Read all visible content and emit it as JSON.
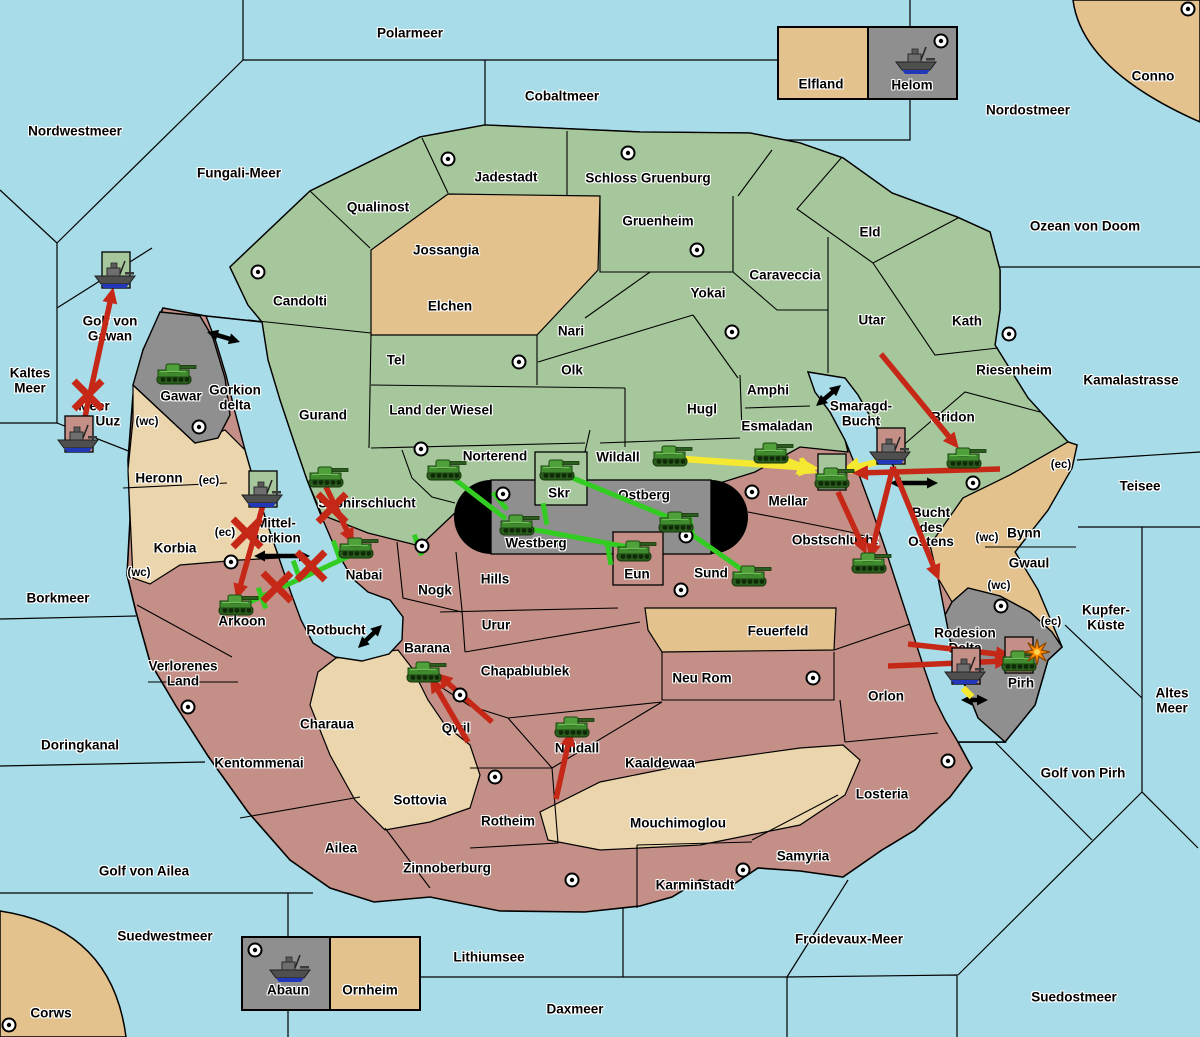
{
  "palette": {
    "sea": "#A8DCE8",
    "green_land": "#A6C79B",
    "tan_light": "#E3C28E",
    "tan_pale": "#EBD5AC",
    "red_land": "#C38F86",
    "gray_land": "#8F8F8F",
    "border": "#000000",
    "arrow_red": "#C62818",
    "arrow_green": "#33CC22",
    "arrow_yellow": "#F5E830",
    "arrow_black": "#000000",
    "explosion": "#FF8C00"
  },
  "labels": [
    {
      "k": "sea",
      "t": "Polarmeer",
      "x": 410,
      "y": 34
    },
    {
      "k": "sea",
      "t": "Nordwestmeer",
      "x": 75,
      "y": 132
    },
    {
      "k": "sea",
      "t": "Fungali-Meer",
      "x": 239,
      "y": 174
    },
    {
      "k": "sea",
      "t": "Cobaltmeer",
      "x": 562,
      "y": 97
    },
    {
      "k": "sea",
      "t": "Nordostmeer",
      "x": 1028,
      "y": 111
    },
    {
      "k": "sea",
      "t": "Conno",
      "x": 1153,
      "y": 77
    },
    {
      "k": "sea",
      "t": "Ozean von Doom",
      "x": 1085,
      "y": 227
    },
    {
      "k": "sea",
      "t": "Kaltes\nMeer",
      "x": 30,
      "y": 381
    },
    {
      "k": "sea",
      "t": "Golf von\nGawan",
      "x": 110,
      "y": 329
    },
    {
      "k": "sea",
      "t": "Meer\nvon Uuz",
      "x": 94,
      "y": 414
    },
    {
      "k": "sea",
      "t": "Gorkion\ndelta",
      "x": 235,
      "y": 398
    },
    {
      "k": "sea",
      "t": "Kamalastrasse",
      "x": 1131,
      "y": 381
    },
    {
      "k": "sea",
      "t": "Teisee",
      "x": 1140,
      "y": 487
    },
    {
      "k": "sea",
      "t": "Borkmeer",
      "x": 58,
      "y": 599
    },
    {
      "k": "sea",
      "t": "Kupfer-\nKüste",
      "x": 1106,
      "y": 618
    },
    {
      "k": "sea",
      "t": "Altes\nMeer",
      "x": 1172,
      "y": 701
    },
    {
      "k": "sea",
      "t": "Golf von Pirh",
      "x": 1083,
      "y": 774
    },
    {
      "k": "sea",
      "t": "Doringkanal",
      "x": 80,
      "y": 746
    },
    {
      "k": "sea",
      "t": "Golf von Ailea",
      "x": 144,
      "y": 872
    },
    {
      "k": "sea",
      "t": "Suedwestmeer",
      "x": 165,
      "y": 937
    },
    {
      "k": "sea",
      "t": "Corws",
      "x": 51,
      "y": 1014
    },
    {
      "k": "sea",
      "t": "Lithiumsee",
      "x": 489,
      "y": 958
    },
    {
      "k": "sea",
      "t": "Daxmeer",
      "x": 575,
      "y": 1010
    },
    {
      "k": "sea",
      "t": "Froidevaux-Meer",
      "x": 849,
      "y": 940
    },
    {
      "k": "sea",
      "t": "Suedostmeer",
      "x": 1074,
      "y": 998
    },
    {
      "k": "sea",
      "t": "Smaragd-\nBucht",
      "x": 861,
      "y": 414
    },
    {
      "k": "sea",
      "t": "Bucht\ndes\nOstens",
      "x": 931,
      "y": 528
    },
    {
      "k": "sea",
      "t": "Rotbucht",
      "x": 336,
      "y": 631
    },
    {
      "k": "sea",
      "t": "Mittel-\ngorkion",
      "x": 276,
      "y": 531
    },
    {
      "k": "land",
      "t": "Jadestadt",
      "x": 506,
      "y": 178
    },
    {
      "k": "land",
      "t": "Schloss Gruenburg",
      "x": 648,
      "y": 179
    },
    {
      "k": "land",
      "t": "Qualinost",
      "x": 378,
      "y": 208
    },
    {
      "k": "land",
      "t": "Jossangia",
      "x": 446,
      "y": 251
    },
    {
      "k": "land",
      "t": "Gruenheim",
      "x": 658,
      "y": 222
    },
    {
      "k": "land",
      "t": "Caraveccia",
      "x": 785,
      "y": 276
    },
    {
      "k": "land",
      "t": "Yokai",
      "x": 708,
      "y": 294
    },
    {
      "k": "land",
      "t": "Candolti",
      "x": 300,
      "y": 302
    },
    {
      "k": "land",
      "t": "Elchen",
      "x": 450,
      "y": 307
    },
    {
      "k": "land",
      "t": "Nari",
      "x": 571,
      "y": 332
    },
    {
      "k": "land",
      "t": "Olk",
      "x": 572,
      "y": 371
    },
    {
      "k": "land",
      "t": "Tel",
      "x": 396,
      "y": 361
    },
    {
      "k": "land",
      "t": "Eld",
      "x": 870,
      "y": 233
    },
    {
      "k": "land",
      "t": "Utar",
      "x": 872,
      "y": 321
    },
    {
      "k": "land",
      "t": "Kath",
      "x": 967,
      "y": 322
    },
    {
      "k": "land",
      "t": "Riesenheim",
      "x": 1014,
      "y": 371
    },
    {
      "k": "land",
      "t": "Land der Wiesel",
      "x": 441,
      "y": 411
    },
    {
      "k": "land",
      "t": "Gurand",
      "x": 323,
      "y": 416
    },
    {
      "k": "land",
      "t": "Hugl",
      "x": 702,
      "y": 410
    },
    {
      "k": "land",
      "t": "Amphi",
      "x": 768,
      "y": 391
    },
    {
      "k": "land",
      "t": "Esmaladan",
      "x": 777,
      "y": 427
    },
    {
      "k": "land",
      "t": "Bridon",
      "x": 953,
      "y": 418
    },
    {
      "k": "land",
      "t": "Norterend",
      "x": 495,
      "y": 457
    },
    {
      "k": "land",
      "t": "Wildall",
      "x": 618,
      "y": 458
    },
    {
      "k": "land",
      "t": "Saphirschlucht",
      "x": 367,
      "y": 504
    },
    {
      "k": "land",
      "t": "Gawar",
      "x": 181,
      "y": 397
    },
    {
      "k": "land",
      "t": "Skr",
      "x": 559,
      "y": 494
    },
    {
      "k": "land",
      "t": "Ostberg",
      "x": 644,
      "y": 496
    },
    {
      "k": "land",
      "t": "Westberg",
      "x": 536,
      "y": 544
    },
    {
      "k": "land",
      "t": "Eun",
      "x": 637,
      "y": 575
    },
    {
      "k": "land",
      "t": "Sund",
      "x": 711,
      "y": 574
    },
    {
      "k": "land",
      "t": "Mellar",
      "x": 788,
      "y": 502
    },
    {
      "k": "land",
      "t": "Obstschlucht",
      "x": 835,
      "y": 541
    },
    {
      "k": "land",
      "t": "Hills",
      "x": 495,
      "y": 580
    },
    {
      "k": "land",
      "t": "Nogk",
      "x": 435,
      "y": 591
    },
    {
      "k": "land",
      "t": "Nabai",
      "x": 364,
      "y": 576
    },
    {
      "k": "land",
      "t": "Urur",
      "x": 496,
      "y": 626
    },
    {
      "k": "land",
      "t": "Arkoon",
      "x": 242,
      "y": 622
    },
    {
      "k": "land",
      "t": "Verlorenes\nLand",
      "x": 183,
      "y": 674
    },
    {
      "k": "land",
      "t": "Barana",
      "x": 427,
      "y": 649
    },
    {
      "k": "land",
      "t": "Feuerfeld",
      "x": 778,
      "y": 632
    },
    {
      "k": "land",
      "t": "Neu Rom",
      "x": 702,
      "y": 679
    },
    {
      "k": "land",
      "t": "Chapablublek",
      "x": 525,
      "y": 672
    },
    {
      "k": "land",
      "t": "Qwil",
      "x": 456,
      "y": 729
    },
    {
      "k": "land",
      "t": "Charaua",
      "x": 327,
      "y": 725
    },
    {
      "k": "land",
      "t": "Kentommenai",
      "x": 259,
      "y": 764
    },
    {
      "k": "land",
      "t": "Orlon",
      "x": 886,
      "y": 697
    },
    {
      "k": "land",
      "t": "Nilldall",
      "x": 577,
      "y": 749
    },
    {
      "k": "land",
      "t": "Kaaldewaa",
      "x": 660,
      "y": 764
    },
    {
      "k": "land",
      "t": "Sottovia",
      "x": 420,
      "y": 801
    },
    {
      "k": "land",
      "t": "Rotheim",
      "x": 508,
      "y": 822
    },
    {
      "k": "land",
      "t": "Mouchimoglou",
      "x": 678,
      "y": 824
    },
    {
      "k": "land",
      "t": "Losteria",
      "x": 882,
      "y": 795
    },
    {
      "k": "land",
      "t": "Ailea",
      "x": 341,
      "y": 849
    },
    {
      "k": "land",
      "t": "Zinnoberburg",
      "x": 447,
      "y": 869
    },
    {
      "k": "land",
      "t": "Karminstadt",
      "x": 695,
      "y": 886
    },
    {
      "k": "land",
      "t": "Samyria",
      "x": 803,
      "y": 857
    },
    {
      "k": "land",
      "t": "Pirh",
      "x": 1021,
      "y": 684
    },
    {
      "k": "land",
      "t": "Gwaul",
      "x": 1029,
      "y": 564
    },
    {
      "k": "land",
      "t": "Bynn",
      "x": 1024,
      "y": 534
    },
    {
      "k": "land",
      "t": "Heronn",
      "x": 159,
      "y": 479
    },
    {
      "k": "land",
      "t": "Korbia",
      "x": 175,
      "y": 549
    },
    {
      "k": "land",
      "t": "Rodesion\nDelta",
      "x": 965,
      "y": 641
    },
    {
      "k": "land",
      "t": "Elfland",
      "x": 821,
      "y": 85
    },
    {
      "k": "land",
      "t": "Helom",
      "x": 912,
      "y": 86
    },
    {
      "k": "land",
      "t": "Abaun",
      "x": 288,
      "y": 991
    },
    {
      "k": "land",
      "t": "Ornheim",
      "x": 370,
      "y": 991
    },
    {
      "k": "coast",
      "t": "(wc)",
      "x": 147,
      "y": 422
    },
    {
      "k": "coast",
      "t": "(ec)",
      "x": 209,
      "y": 481
    },
    {
      "k": "coast",
      "t": "(ec)",
      "x": 225,
      "y": 533
    },
    {
      "k": "coast",
      "t": "(wc)",
      "x": 139,
      "y": 573
    },
    {
      "k": "coast",
      "t": "(wc)",
      "x": 987,
      "y": 538
    },
    {
      "k": "coast",
      "t": "(ec)",
      "x": 1061,
      "y": 465
    },
    {
      "k": "coast",
      "t": "(wc)",
      "x": 999,
      "y": 586
    },
    {
      "k": "coast",
      "t": "(ec)",
      "x": 1051,
      "y": 622
    }
  ],
  "city_markers": [
    [
      448,
      159
    ],
    [
      628,
      153
    ],
    [
      697,
      250
    ],
    [
      258,
      272
    ],
    [
      519,
      362
    ],
    [
      732,
      332
    ],
    [
      941,
      41
    ],
    [
      1188,
      9
    ],
    [
      1009,
      334
    ],
    [
      973,
      483
    ],
    [
      421,
      449
    ],
    [
      503,
      494
    ],
    [
      686,
      536
    ],
    [
      681,
      590
    ],
    [
      752,
      492
    ],
    [
      948,
      761
    ],
    [
      1001,
      606
    ],
    [
      231,
      562
    ],
    [
      422,
      546
    ],
    [
      460,
      695
    ],
    [
      813,
      678
    ],
    [
      495,
      777
    ],
    [
      572,
      880
    ],
    [
      743,
      870
    ],
    [
      188,
      707
    ],
    [
      9,
      1025
    ],
    [
      255,
      950
    ],
    [
      199,
      427
    ]
  ],
  "units": [
    {
      "id": "helom-ship",
      "kind": "ship",
      "x": 917,
      "y": 62,
      "box": null
    },
    {
      "id": "gawan-ship",
      "kind": "ship",
      "x": 116,
      "y": 276,
      "box": "green"
    },
    {
      "id": "uuz-ship",
      "kind": "ship",
      "x": 79,
      "y": 440,
      "box": "pink"
    },
    {
      "id": "mittelgorkion-ship",
      "kind": "ship",
      "x": 263,
      "y": 495,
      "box": "green"
    },
    {
      "id": "ostens-ship",
      "kind": "ship",
      "x": 891,
      "y": 452,
      "box": "pink"
    },
    {
      "id": "rodesion-ship",
      "kind": "ship",
      "x": 966,
      "y": 672,
      "box": "pink"
    },
    {
      "id": "abaun-ship",
      "kind": "ship",
      "x": 291,
      "y": 970,
      "box": null
    },
    {
      "id": "gawar-tank",
      "kind": "tank",
      "x": 174,
      "y": 374,
      "box": null
    },
    {
      "id": "saphirschlucht-tank",
      "kind": "tank",
      "x": 326,
      "y": 477,
      "box": null
    },
    {
      "id": "norterend-tank",
      "kind": "tank",
      "x": 444,
      "y": 470,
      "box": null
    },
    {
      "id": "skr-tank",
      "kind": "tank",
      "x": 557,
      "y": 470,
      "box": null
    },
    {
      "id": "wildall-tank",
      "kind": "tank",
      "x": 670,
      "y": 456,
      "box": null
    },
    {
      "id": "westberg-tank",
      "kind": "tank",
      "x": 517,
      "y": 525,
      "box": null
    },
    {
      "id": "ostberg-tank",
      "kind": "tank",
      "x": 676,
      "y": 522,
      "box": null
    },
    {
      "id": "eun-tank",
      "kind": "tank",
      "x": 634,
      "y": 551,
      "box": null
    },
    {
      "id": "sund-tank",
      "kind": "tank",
      "x": 749,
      "y": 576,
      "box": null
    },
    {
      "id": "esmaladan-tank",
      "kind": "tank",
      "x": 771,
      "y": 453,
      "box": null
    },
    {
      "id": "mellar-tank",
      "kind": "tank",
      "x": 832,
      "y": 478,
      "box": "green"
    },
    {
      "id": "bridon-tank",
      "kind": "tank",
      "x": 964,
      "y": 458,
      "box": null
    },
    {
      "id": "obstschlucht-tank",
      "kind": "tank",
      "x": 869,
      "y": 563,
      "box": null
    },
    {
      "id": "nabai-tank",
      "kind": "tank",
      "x": 356,
      "y": 548,
      "box": null
    },
    {
      "id": "arkoon-tank",
      "kind": "tank",
      "x": 236,
      "y": 605,
      "box": null
    },
    {
      "id": "barana-tank",
      "kind": "tank",
      "x": 424,
      "y": 672,
      "box": null
    },
    {
      "id": "nilldall-tank",
      "kind": "tank",
      "x": 572,
      "y": 727,
      "box": null
    },
    {
      "id": "pirh-tank",
      "kind": "tank",
      "x": 1019,
      "y": 661,
      "box": "pink"
    }
  ],
  "explosion": {
    "x": 1037,
    "y": 652
  },
  "attack_arrows": [
    {
      "c": "green",
      "p": [
        [
          448,
          474
        ],
        [
          506,
          519
        ]
      ],
      "h": 0
    },
    {
      "c": "green",
      "p": [
        [
          520,
          527
        ],
        [
          628,
          547
        ]
      ],
      "h": 0
    },
    {
      "c": "green",
      "p": [
        [
          563,
          474
        ],
        [
          668,
          517
        ]
      ],
      "h": 0
    },
    {
      "c": "green",
      "p": [
        [
          681,
          527
        ],
        [
          744,
          571
        ]
      ],
      "h": 0
    },
    {
      "c": "green",
      "p": [
        [
          356,
          553
        ],
        [
          250,
          602
        ]
      ],
      "h": 0
    },
    {
      "c": "yellow",
      "p": [
        [
          684,
          459
        ],
        [
          813,
          468
        ]
      ],
      "h": 1
    },
    {
      "c": "yellow",
      "p": [
        [
          778,
          457
        ],
        [
          812,
          471
        ]
      ],
      "h": 1
    },
    {
      "c": "yellow",
      "p": [
        [
          877,
          462
        ],
        [
          846,
          470
        ]
      ],
      "h": 1
    },
    {
      "c": "yellow",
      "p": [
        [
          967,
          662
        ],
        [
          951,
          679
        ]
      ],
      "h": 0
    },
    {
      "c": "yellow",
      "p": [
        [
          963,
          688
        ],
        [
          972,
          697
        ]
      ],
      "h": 0
    },
    {
      "c": "red",
      "p": [
        [
          80,
          440
        ],
        [
          112,
          293
        ]
      ],
      "h": 1
    },
    {
      "c": "red",
      "p": [
        [
          263,
          505
        ],
        [
          238,
          594
        ]
      ],
      "h": 1
    },
    {
      "c": "red",
      "p": [
        [
          326,
          487
        ],
        [
          351,
          539
        ]
      ],
      "h": 1
    },
    {
      "c": "red",
      "p": [
        [
          1000,
          469
        ],
        [
          858,
          473
        ]
      ],
      "h": 1
    },
    {
      "c": "red",
      "p": [
        [
          893,
          467
        ],
        [
          871,
          554
        ]
      ],
      "h": 1
    },
    {
      "c": "red",
      "p": [
        [
          893,
          467
        ],
        [
          937,
          575
        ]
      ],
      "h": 1
    },
    {
      "c": "red",
      "p": [
        [
          838,
          492
        ],
        [
          864,
          549
        ]
      ],
      "h": 1
    },
    {
      "c": "red",
      "p": [
        [
          881,
          354
        ],
        [
          955,
          444
        ]
      ],
      "h": 1
    },
    {
      "c": "red",
      "p": [
        [
          468,
          742
        ],
        [
          433,
          682
        ]
      ],
      "h": 1
    },
    {
      "c": "red",
      "p": [
        [
          492,
          722
        ],
        [
          441,
          677
        ]
      ],
      "h": 1
    },
    {
      "c": "red",
      "p": [
        [
          556,
          799
        ],
        [
          570,
          736
        ]
      ],
      "h": 1
    },
    {
      "c": "red",
      "p": [
        [
          888,
          666
        ],
        [
          1005,
          661
        ]
      ],
      "h": 1
    },
    {
      "c": "red",
      "p": [
        [
          908,
          644
        ],
        [
          1006,
          655
        ]
      ],
      "h": 1
    }
  ],
  "blocked_marks": [
    [
      88,
      395
    ],
    [
      247,
      533
    ],
    [
      332,
      508
    ],
    [
      311,
      566
    ],
    [
      277,
      587
    ]
  ],
  "green_ticks": [
    [
      500,
      501,
      50
    ],
    [
      609,
      554,
      80
    ],
    [
      691,
      526,
      80
    ],
    [
      418,
      545,
      70
    ],
    [
      337,
      551,
      70
    ],
    [
      297,
      571,
      70
    ],
    [
      262,
      598,
      70
    ],
    [
      545,
      514,
      80
    ]
  ],
  "transport_links": [
    [
      207,
      332,
      240,
      342
    ],
    [
      816,
      406,
      841,
      385
    ],
    [
      890,
      483,
      938,
      483
    ],
    [
      254,
      556,
      310,
      556
    ],
    [
      358,
      648,
      382,
      625
    ],
    [
      961,
      700,
      988,
      700
    ]
  ]
}
